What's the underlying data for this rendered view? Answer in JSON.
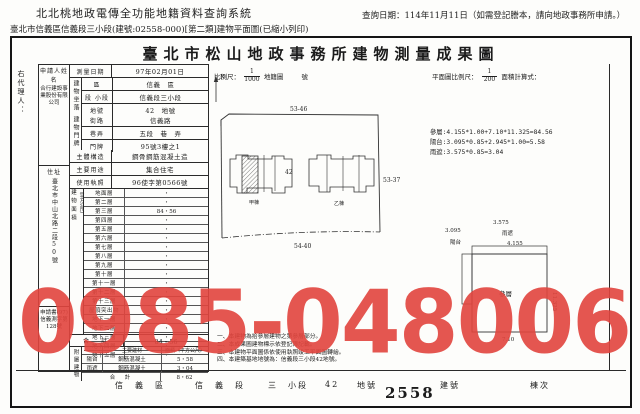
{
  "header": {
    "system_title": "北北桃地政電傳全功能地籍資料查詢系統",
    "subtitle": "臺北市信義區信義段三小段(建號:02558-000)[第二類]建物平面圖(已縮小列印)",
    "query_date": "查詢日期：114年11月11日（如需登記謄本，請向地政事務所申請。）"
  },
  "doc": {
    "title": "臺北市松山地政事務所建物測量成果圖",
    "scale": {
      "label": "比例尺：",
      "numerator": "1",
      "denominator": "1000",
      "map_label": "地籍圖",
      "map_no_label": "號"
    },
    "plan_scale": {
      "label": "平面圖比例尺：",
      "numerator": "1",
      "denominator": "200",
      "calc_label": "面積計算式："
    },
    "formulas": [
      "參層:4.155*1.00+7.10*11.325=84.56",
      "陽台:3.095*0.85+2.945*1.00=5.58",
      "雨遮:3.575*0.85=3.04"
    ],
    "notes": [
      "一、本建物為拾參層建物之第參層部分。",
      "二、本成果圖建物標示依登記簿記載。",
      "三、本建物平面圖係依使用執照竣工平面圖轉繪。",
      "四、本建築基地地號為：信義段三小段42地號。"
    ]
  },
  "form": {
    "agent_label": "右代理人：",
    "applicant": {
      "label": "申請人姓名",
      "value": "合行建設事業股份有限公司"
    },
    "address": {
      "label": "住址",
      "value": "臺北市中山北路二段50號"
    },
    "application_no": "申請書(97)信義測字第128號",
    "survey_date": {
      "label": "測量日期",
      "value": "97年02月01日"
    },
    "location": {
      "group": "建物坐落",
      "rows": [
        {
          "label": "區",
          "value": "信義　區"
        },
        {
          "label": "段 小段",
          "value": "信義段三小段"
        },
        {
          "label": "地號",
          "value": "42　地號"
        }
      ]
    },
    "doorplate": {
      "group": "建物門牌",
      "rows": [
        {
          "label": "街路",
          "value": "信義路"
        },
        {
          "label": "巷弄",
          "value": "五段　巷　弄"
        },
        {
          "label": "門牌",
          "value": "95號3樓之1"
        }
      ]
    },
    "structure": {
      "label": "主體構造",
      "value": "鋼骨鋼筋混凝土造"
    },
    "usage": {
      "label": "主要用途",
      "value": "集合住宅"
    },
    "license": {
      "label": "使用執照",
      "value": "96使字第0566號"
    },
    "floor_area": {
      "group": "建物面積",
      "unit": "（平方公尺）",
      "rows": [
        {
          "label": "地面層",
          "value": "・"
        },
        {
          "label": "第二層",
          "value": "・"
        },
        {
          "label": "第三層",
          "value": "84・56"
        },
        {
          "label": "第四層",
          "value": "・"
        },
        {
          "label": "第五層",
          "value": "・"
        },
        {
          "label": "第六層",
          "value": "・"
        },
        {
          "label": "第七層",
          "value": "・"
        },
        {
          "label": "第八層",
          "value": "・"
        },
        {
          "label": "第九層",
          "value": "・"
        },
        {
          "label": "第十層",
          "value": "・"
        },
        {
          "label": "第十一層",
          "value": "・"
        },
        {
          "label": "第十二層",
          "value": "・"
        },
        {
          "label": "第十三層",
          "value": "・"
        },
        {
          "label": "屋頂突出物",
          "value": "・"
        },
        {
          "label": "地下一層",
          "value": "・"
        },
        {
          "label": "地下二層",
          "value": "・"
        },
        {
          "label": "地下三層",
          "value": "・"
        },
        {
          "label": "地下四層",
          "value": "・"
        },
        {
          "label": "地下五層",
          "value": "・"
        }
      ],
      "total_label": "合　計",
      "total_value": "84・56"
    },
    "attachments": {
      "group": "附屬建物",
      "material_header": "主要建材",
      "area_header": "面積（平方公尺）",
      "rows": [
        {
          "name": "陽台",
          "material": "鋼筋混凝土",
          "area": "5・58"
        },
        {
          "name": "雨遮",
          "material": "鋼筋混凝土",
          "area": "3・04"
        }
      ],
      "total_label": "合　計",
      "total_value": "8・62"
    }
  },
  "map": {
    "north": "N",
    "top_label": "53-46",
    "right_label": "53-37",
    "bottom_label": "54-40",
    "parcel": "42",
    "left_building": "甲棟",
    "right_building": "乙棟"
  },
  "plan": {
    "room": "參層",
    "balcony": "陽台",
    "canopy": "雨遮",
    "d_3095": "3.095",
    "d_3575": "3.575",
    "d_4155": "4.155",
    "d_11325": "11.325",
    "d_710": "7.10"
  },
  "footer": {
    "district": "信　義　區",
    "section": "信　義　段",
    "subsection": "三　小段",
    "parcel": "42",
    "parcel_unit": "地號",
    "building_no": "2558",
    "building_unit": "建號",
    "unit_label": "棟次"
  },
  "watermark": {
    "text": "0985-048006",
    "color": "#e2453e"
  }
}
